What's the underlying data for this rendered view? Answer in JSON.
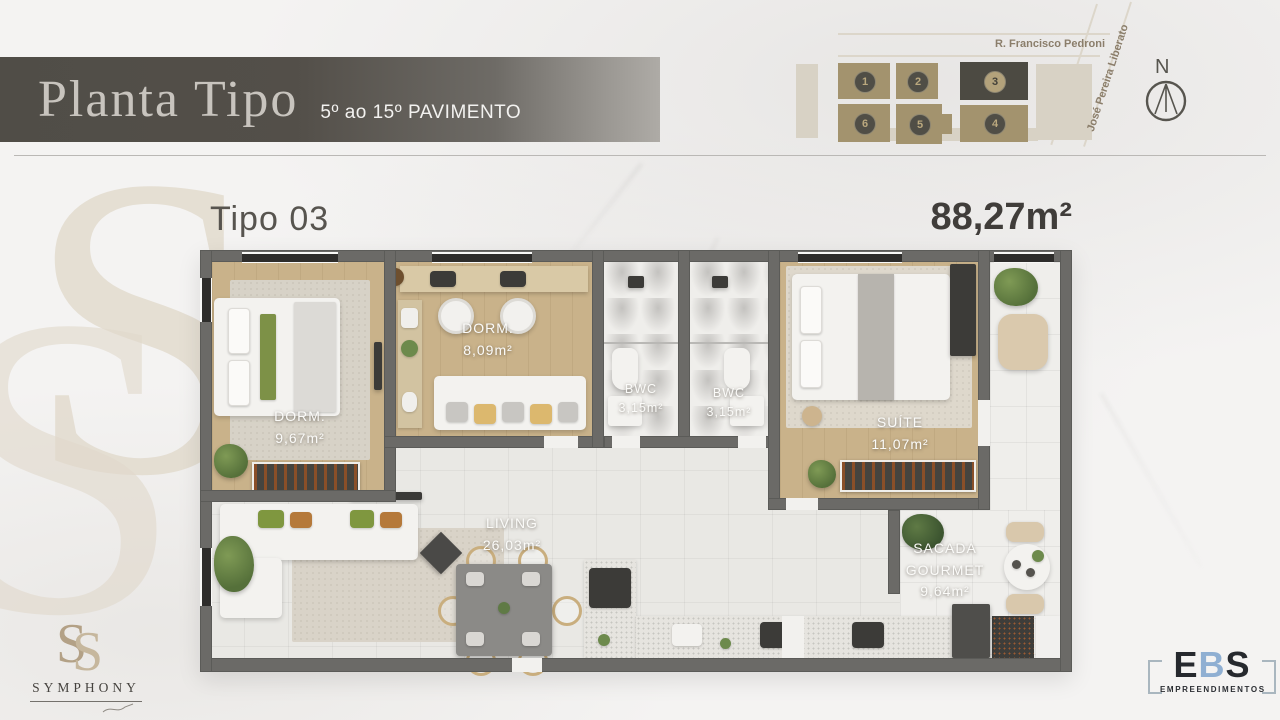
{
  "header": {
    "title": "Planta Tipo",
    "subtitle": "5º ao 15º PAVIMENTO"
  },
  "site_map": {
    "street_horizontal": "R. Francisco Pedroni",
    "street_diagonal": "José Pereira Liberato",
    "compass_label": "N",
    "units": [
      {
        "number": "1",
        "highlighted": false
      },
      {
        "number": "2",
        "highlighted": false
      },
      {
        "number": "3",
        "highlighted": true
      },
      {
        "number": "6",
        "highlighted": false
      },
      {
        "number": "5",
        "highlighted": false
      },
      {
        "number": "4",
        "highlighted": false
      }
    ]
  },
  "plan": {
    "type_label": "Tipo 03",
    "total_area": "88,27m²",
    "rooms": {
      "dorm1": {
        "name": "DORM.",
        "area": "9,67m²"
      },
      "dorm2": {
        "name": "DORM.",
        "area": "8,09m²"
      },
      "bwc1": {
        "name": "BWC",
        "area": "3,15m²"
      },
      "bwc2": {
        "name": "BWC",
        "area": "3,15m²"
      },
      "suite": {
        "name": "SUÍTE",
        "area": "11,07m²"
      },
      "living": {
        "name": "LIVING",
        "area": "26,03m²"
      },
      "sacada": {
        "name": "SACADA GOURMET",
        "area": "9,64m²"
      }
    }
  },
  "footer": {
    "symphony": {
      "monogram": "S",
      "name": "SYMPHONY"
    },
    "ebs": {
      "letter_e": "E",
      "letter_b": "B",
      "letter_s": "S",
      "subtitle": "EMPREENDIMENTOS"
    }
  },
  "colors": {
    "accent_tan": "#a3936e",
    "map_dark": "#4c4a42",
    "wall_gray": "#6b6a67",
    "ebs_blue": "#8fafd2",
    "banner_dark": "#504d47"
  }
}
